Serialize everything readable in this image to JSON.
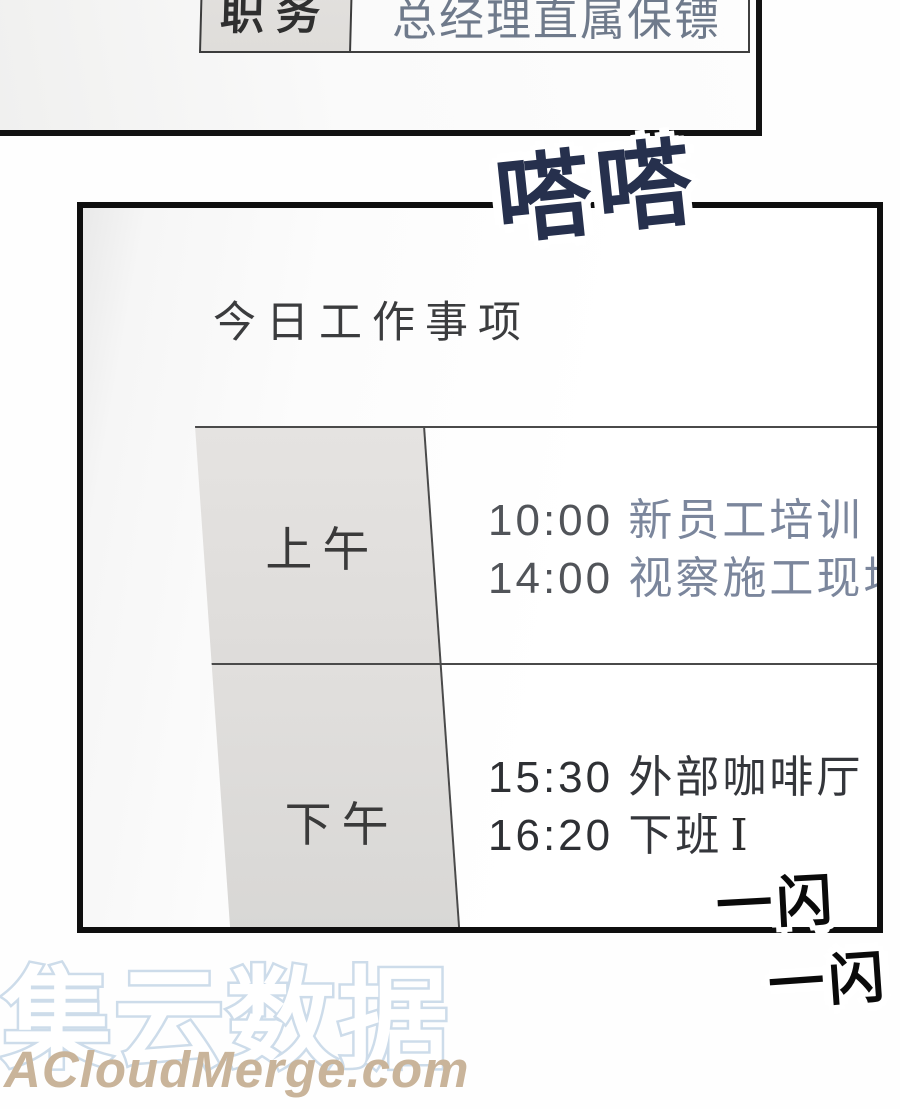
{
  "colors": {
    "panel_border": "#0e0e0e",
    "table_line": "#4a4a4a",
    "table_header_gray": "#e3e1df",
    "sfx_ink_navy": "#26304d",
    "sfx_ink_black": "#0a0a0a",
    "morning_time": "#515459",
    "morning_activity": "#7b869c",
    "afternoon_text": "#2e3034",
    "profile_value_text": "#6f7a8b",
    "watermark_outline": "#cddcea",
    "watermark_en_text": "#c9b49a"
  },
  "top_panel": {
    "profile_row": {
      "label": "职务",
      "value": "总经理直属保镖"
    }
  },
  "sfx": {
    "tap": "嗒嗒",
    "flash_inside": "一闪",
    "flash_outside": "一闪"
  },
  "main_panel": {
    "title": "今日工作事项",
    "schedule": {
      "rows": [
        {
          "period": "上午",
          "entries": [
            {
              "time": "10:00",
              "activity": "新员工培训"
            },
            {
              "time": "14:00",
              "activity": "视察施工现场"
            }
          ]
        },
        {
          "period": "下午",
          "entries": [
            {
              "time": "15:30",
              "activity": "外部咖啡厅"
            },
            {
              "time": "16:20",
              "activity": "下班"
            }
          ]
        }
      ],
      "cursor": "I"
    }
  },
  "watermark": {
    "cn": "集云数据",
    "en": "ACloudMerge.com"
  }
}
